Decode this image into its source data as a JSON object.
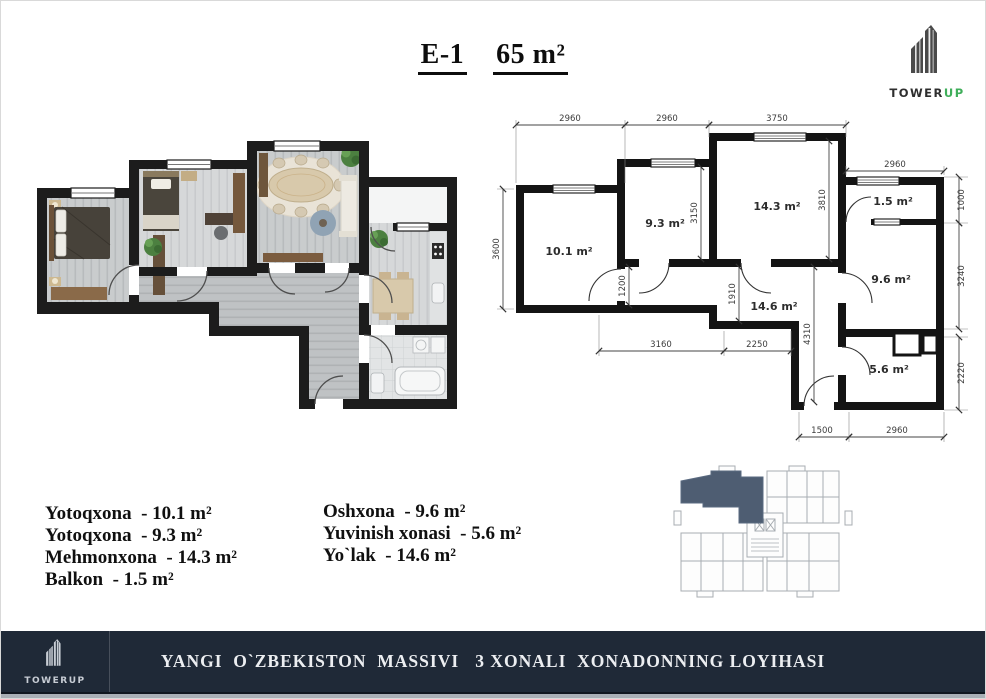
{
  "header": {
    "code": "E-1",
    "area": "65 m²"
  },
  "brand": {
    "tower": "TOWER",
    "up": "UP",
    "accent": "#3fae5a"
  },
  "plan": {
    "rooms": {
      "bedroom1": "10.1 m²",
      "bedroom2": "9.3 m²",
      "living": "14.3 m²",
      "balcony": "1.5 m²",
      "kitchen": "9.6 m²",
      "hall": "14.6 m²",
      "bath": "5.6 m²"
    },
    "dims": {
      "top": [
        "2960",
        "2960",
        "3750"
      ],
      "balcony_top": "2960",
      "left": "3600",
      "right": [
        "1000",
        "3240",
        "2220"
      ],
      "inner_bottom": [
        "3160",
        "2250"
      ],
      "bottom": [
        "1500",
        "2960"
      ],
      "vertical": [
        "3150",
        "3810",
        "1200",
        "1910",
        "4310"
      ]
    }
  },
  "legend": {
    "separator": "  - ",
    "left": [
      {
        "name": "Yotoqxona",
        "area": "10.1 m²"
      },
      {
        "name": "Yotoqxona",
        "area": "9.3 m²"
      },
      {
        "name": "Mehmonxona",
        "area": "14.3 m²"
      },
      {
        "name": "Balkon",
        "area": "1.5 m²"
      }
    ],
    "right": [
      {
        "name": "Oshxona",
        "area": "9.6 m²"
      },
      {
        "name": "Yuvinish xonasi",
        "area": "5.6 m²"
      },
      {
        "name": "Yo`lak",
        "area": "14.6 m²"
      }
    ]
  },
  "keyplan": {
    "highlight": "#4e5d72"
  },
  "footer": {
    "caption": "YANGI  O`ZBEKISTON  MASSIVI   3 XONALI  XONADONNING LOYIHASI",
    "bg": "#1f2937"
  }
}
